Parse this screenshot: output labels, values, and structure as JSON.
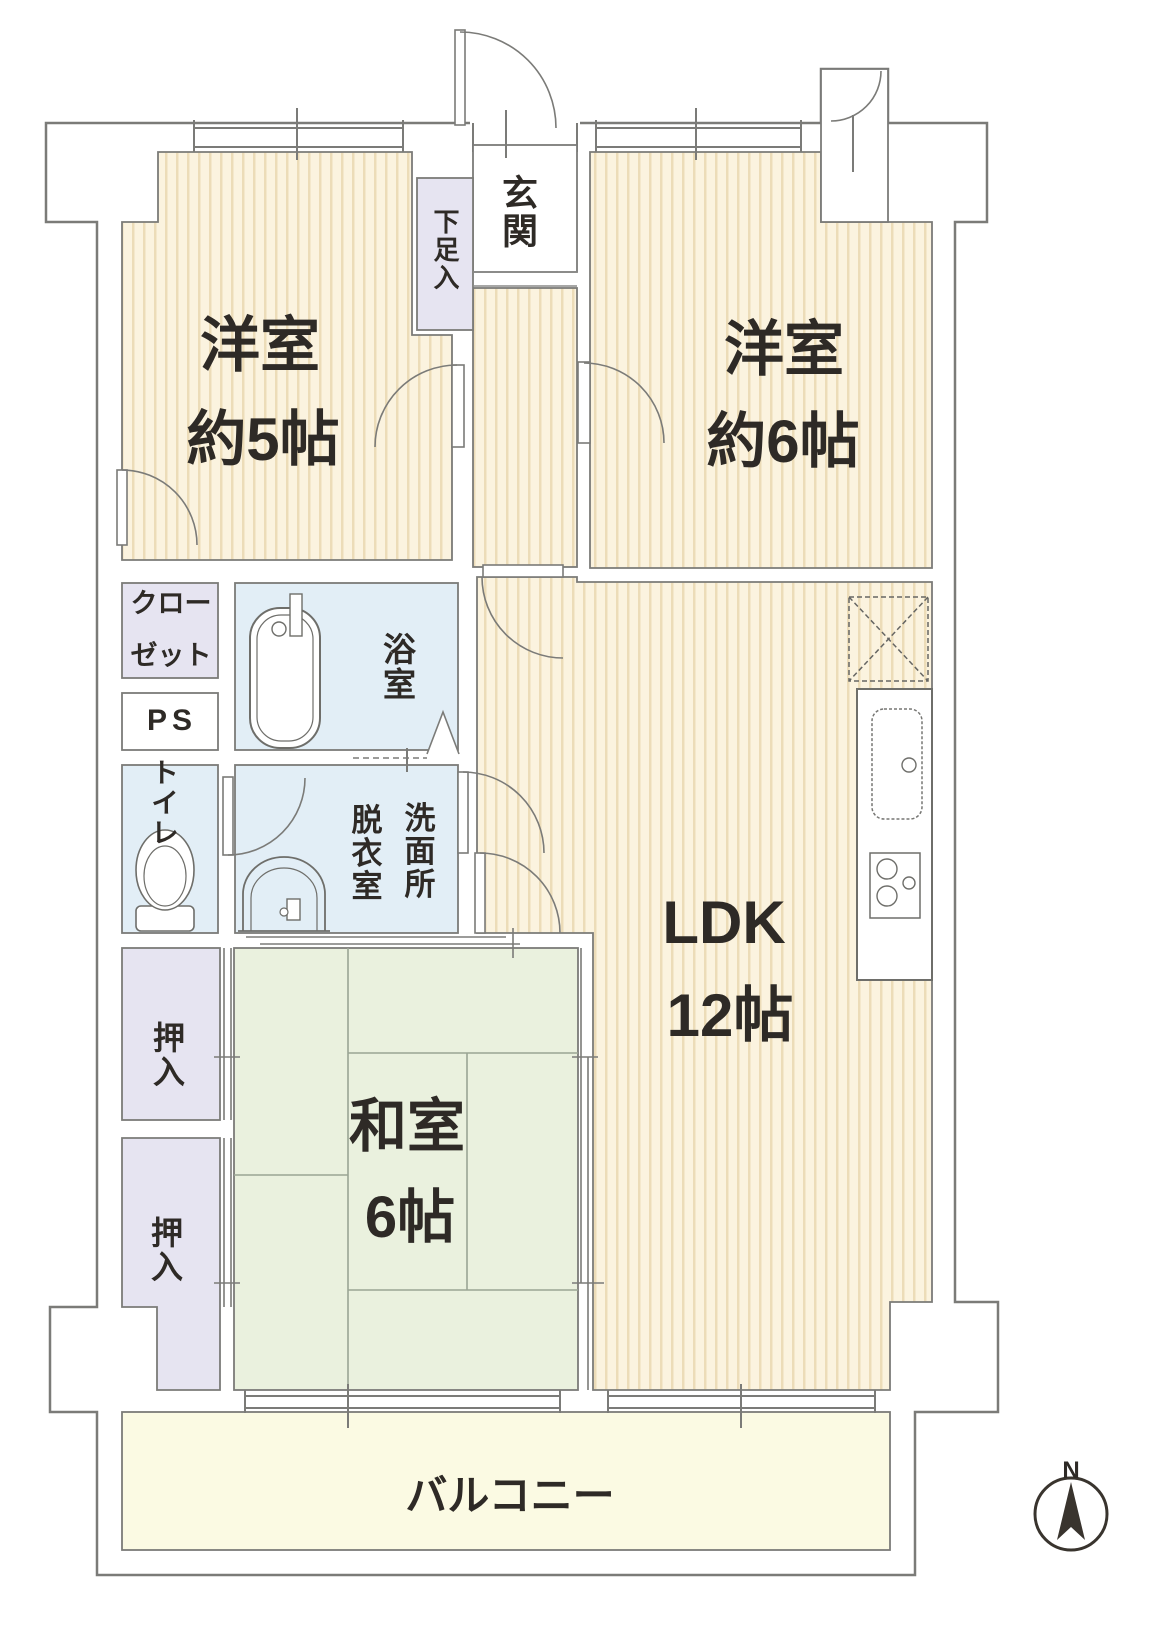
{
  "plan": {
    "rooms": {
      "west5": {
        "name": "洋室",
        "size": "約5帖"
      },
      "west6": {
        "name": "洋室",
        "size": "約6帖"
      },
      "ldk": {
        "name": "LDK",
        "size": "12帖"
      },
      "washitsu": {
        "name": "和室",
        "size": "6帖"
      },
      "balcony": {
        "name": "バルコニー"
      },
      "genkan": {
        "name": "玄関"
      },
      "shoe_cabinet": {
        "name": "下足入"
      },
      "closet": {
        "name_line1": "クロー",
        "name_line2": "ゼット"
      },
      "pipe_space": {
        "name": "PS"
      },
      "toilet": {
        "name": "トイレ"
      },
      "bath": {
        "name": "浴室"
      },
      "dressing_room": {
        "name": "脱衣室"
      },
      "washroom": {
        "name": "洗面所"
      },
      "oshiire_upper": {
        "name": "押入"
      },
      "oshiire_lower": {
        "name": "押入"
      }
    },
    "compass": {
      "north_label": "N"
    },
    "colors": {
      "flooring_base": "#fbf3df",
      "flooring_stripe": "#ecdcb8",
      "tatami": "#eaf1de",
      "storage": "#e6e4f1",
      "wet_area": "#e2eef6",
      "balcony": "#fbfae3",
      "wall_line": "#7b7b78",
      "text": "#2e2a26"
    }
  }
}
